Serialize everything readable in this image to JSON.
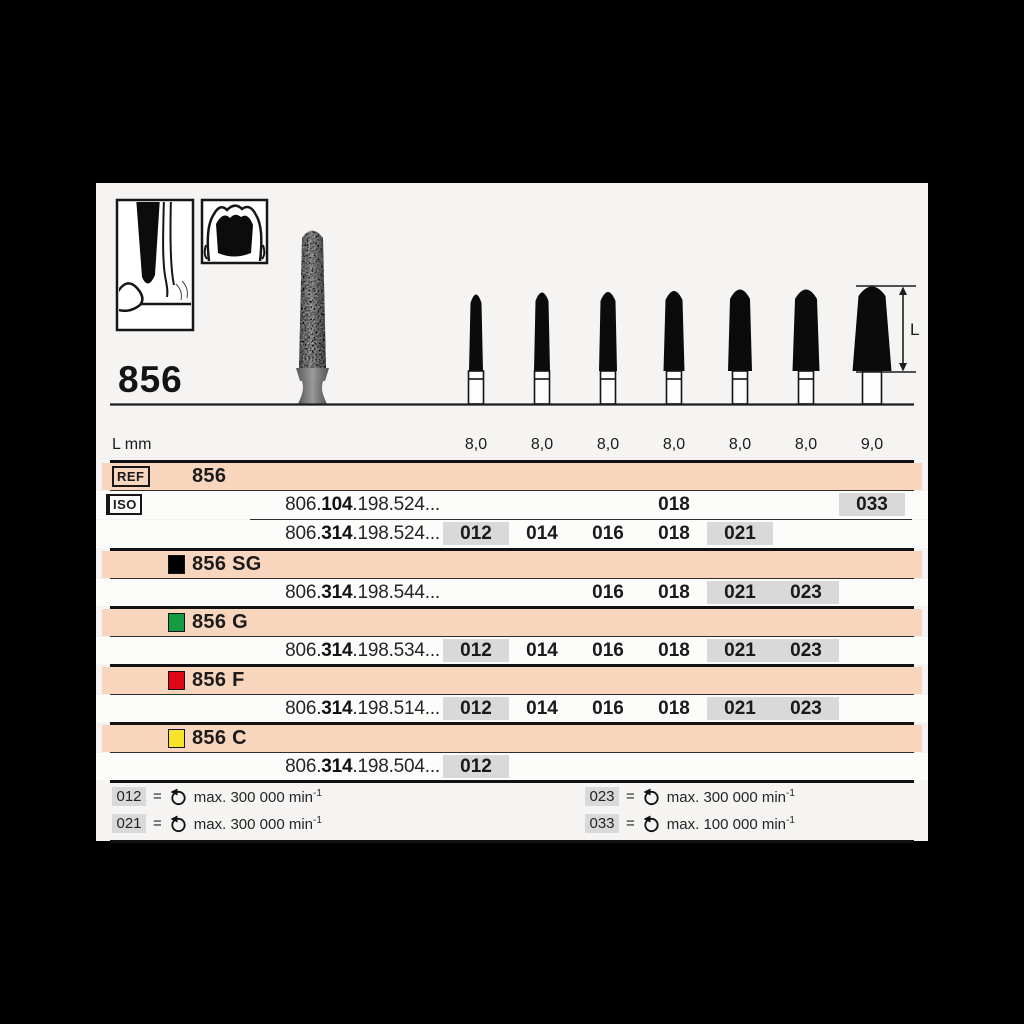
{
  "title": {
    "ref": "856"
  },
  "header": {
    "l_dim_label": "L"
  },
  "size_row": {
    "label": "L mm",
    "values": [
      "8,0",
      "8,0",
      "8,0",
      "8,0",
      "8,0",
      "8,0",
      "9,0"
    ]
  },
  "ref_row": {
    "tag": "REF",
    "value": "856"
  },
  "iso_tag": "ISO",
  "main_rows": [
    {
      "prefix": "806.",
      "bold": "104",
      "suffix": ".198.524...",
      "cells": {
        "c4": "018",
        "c7": "033"
      }
    },
    {
      "prefix": "806.",
      "bold": "314",
      "suffix": ".198.524...",
      "cells": {
        "c1": "012",
        "c2": "014",
        "c3": "016",
        "c4": "018",
        "c5": "021"
      }
    }
  ],
  "products": [
    {
      "name": "856 SG",
      "swatch": "#000000",
      "row": {
        "prefix": "806.",
        "bold": "314",
        "suffix": ".198.544...",
        "cells": {
          "c3": "016",
          "c4": "018",
          "c5": "021",
          "c6": "023"
        }
      }
    },
    {
      "name": "856 G",
      "swatch": "#149b44",
      "row": {
        "prefix": "806.",
        "bold": "314",
        "suffix": ".198.534...",
        "cells": {
          "c1": "012",
          "c2": "014",
          "c3": "016",
          "c4": "018",
          "c5": "021",
          "c6": "023"
        }
      }
    },
    {
      "name": "856 F",
      "swatch": "#df0715",
      "row": {
        "prefix": "806.",
        "bold": "314",
        "suffix": ".198.514...",
        "cells": {
          "c1": "012",
          "c2": "014",
          "c3": "016",
          "c4": "018",
          "c5": "021",
          "c6": "023"
        }
      }
    },
    {
      "name": "856 C",
      "swatch": "#f6e32a",
      "row": {
        "prefix": "806.",
        "bold": "314",
        "suffix": ".198.504...",
        "cells": {
          "c1": "012"
        }
      }
    }
  ],
  "legend": {
    "eq": "=",
    "items": [
      {
        "code": "012",
        "text": "max. 300 000 min",
        "sup": "-1"
      },
      {
        "code": "023",
        "text": "max. 300 000 min",
        "sup": "-1"
      },
      {
        "code": "021",
        "text": "max. 300 000 min",
        "sup": "-1"
      },
      {
        "code": "033",
        "text": "max. 100 000 min",
        "sup": "-1"
      }
    ]
  },
  "colors": {
    "band": "#f8d5bd",
    "gray_cell": "#d9d9d9"
  }
}
